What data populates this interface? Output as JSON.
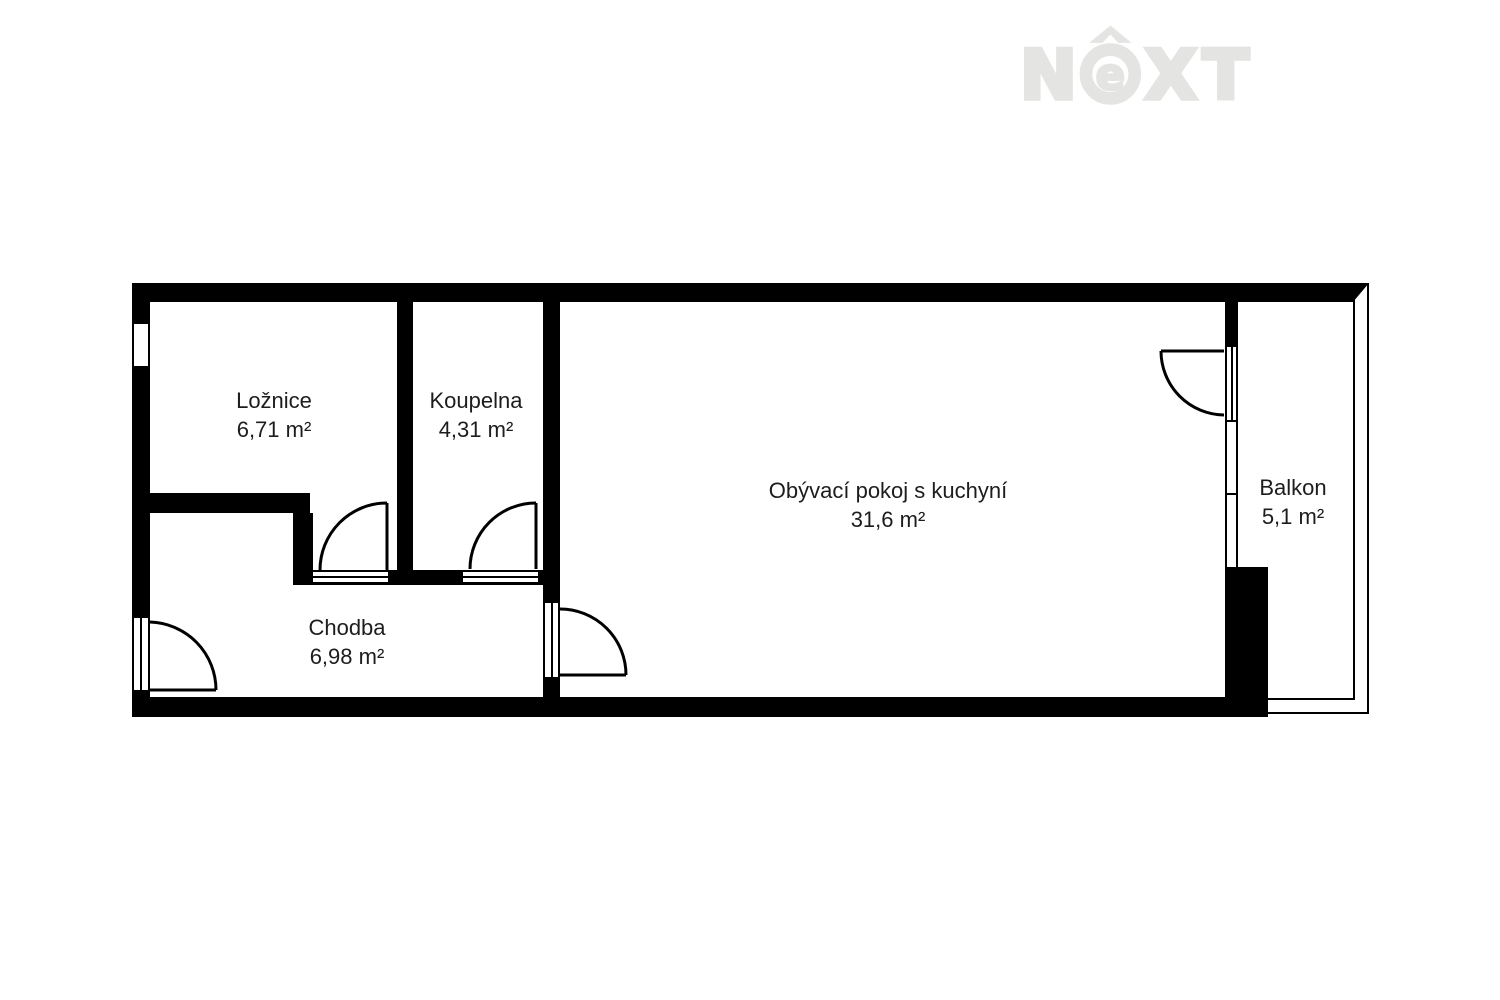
{
  "page": {
    "background": "#ffffff"
  },
  "logo": {
    "letters": [
      "N",
      "e",
      "X",
      "T"
    ],
    "color": "#e4e4e2"
  },
  "plan": {
    "wall_color": "#000000",
    "text_color": "#1d1d1d",
    "rooms": [
      {
        "id": "loznice",
        "name": "Ložnice",
        "area": "6,71 m²"
      },
      {
        "id": "koupelna",
        "name": "Koupelna",
        "area": "4,31 m²"
      },
      {
        "id": "obyvaci-pokoj",
        "name": "Obývací pokoj s kuchyní",
        "area": "31,6 m²"
      },
      {
        "id": "chodba",
        "name": "Chodba",
        "area": "6,98 m²"
      },
      {
        "id": "balkon",
        "name": "Balkon",
        "area": "5,1 m²"
      }
    ]
  }
}
